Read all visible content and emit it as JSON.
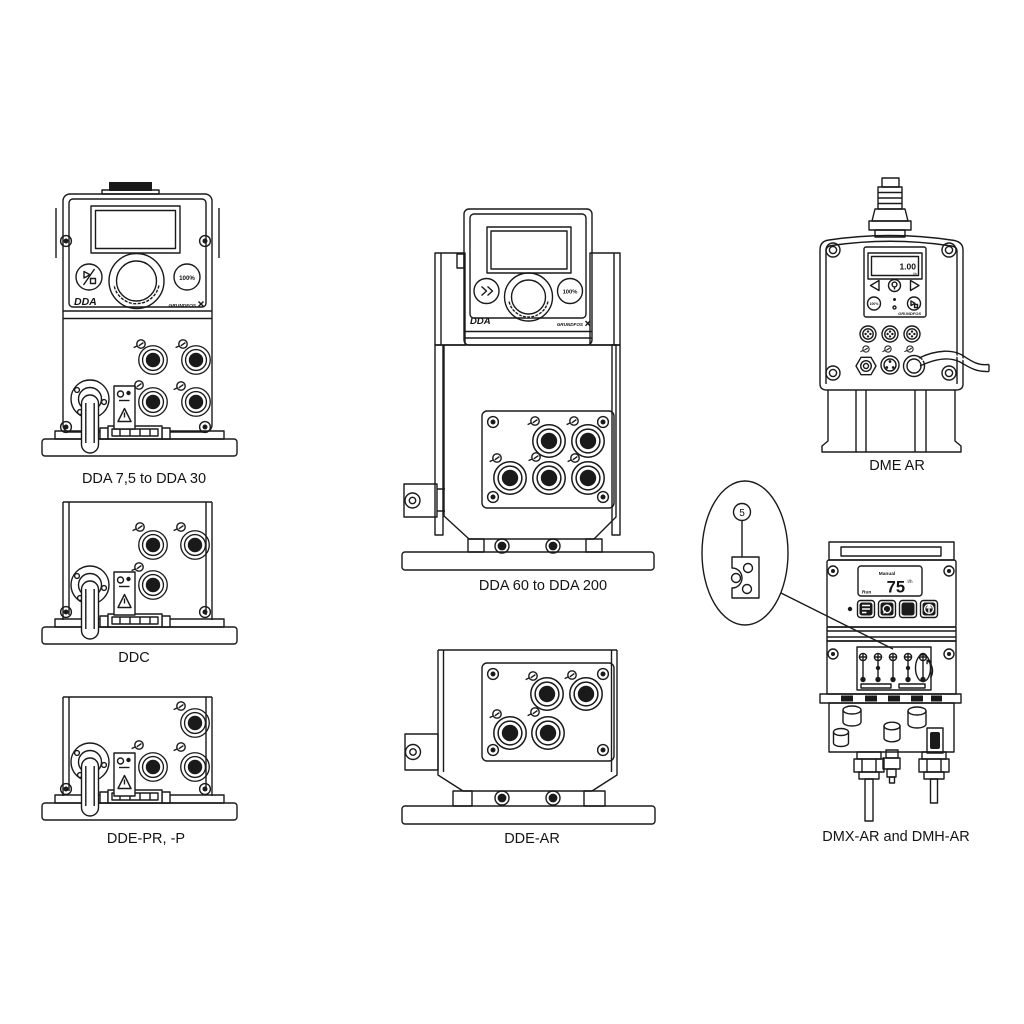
{
  "page": {
    "background": "#ffffff",
    "line_color": "#1a1a1a"
  },
  "figures": {
    "dda_small": {
      "label": "DDA 7,5 to DDA 30",
      "model": "DDA",
      "brand": "GRUNDFOS",
      "button_100": "100%"
    },
    "ddc": {
      "label": "DDC"
    },
    "dde_pr": {
      "label": "DDE-PR, -P"
    },
    "dda_large": {
      "label": "DDA 60 to DDA 200",
      "model": "DDA",
      "brand": "GRUNDFOS",
      "button_100": "100%"
    },
    "dde_ar": {
      "label": "DDE-AR"
    },
    "dme_ar": {
      "label": "DME AR",
      "brand": "GRUNDFOS",
      "button_100": "100%",
      "display_value": "1.00",
      "display_unit": "l/h"
    },
    "dmx_dmh": {
      "label": "DMX-AR and DMH-AR",
      "display_mode": "Manual",
      "display_value": "75",
      "display_unit": "l/h",
      "display_status": "Run"
    }
  },
  "callout": {
    "number": "5"
  }
}
